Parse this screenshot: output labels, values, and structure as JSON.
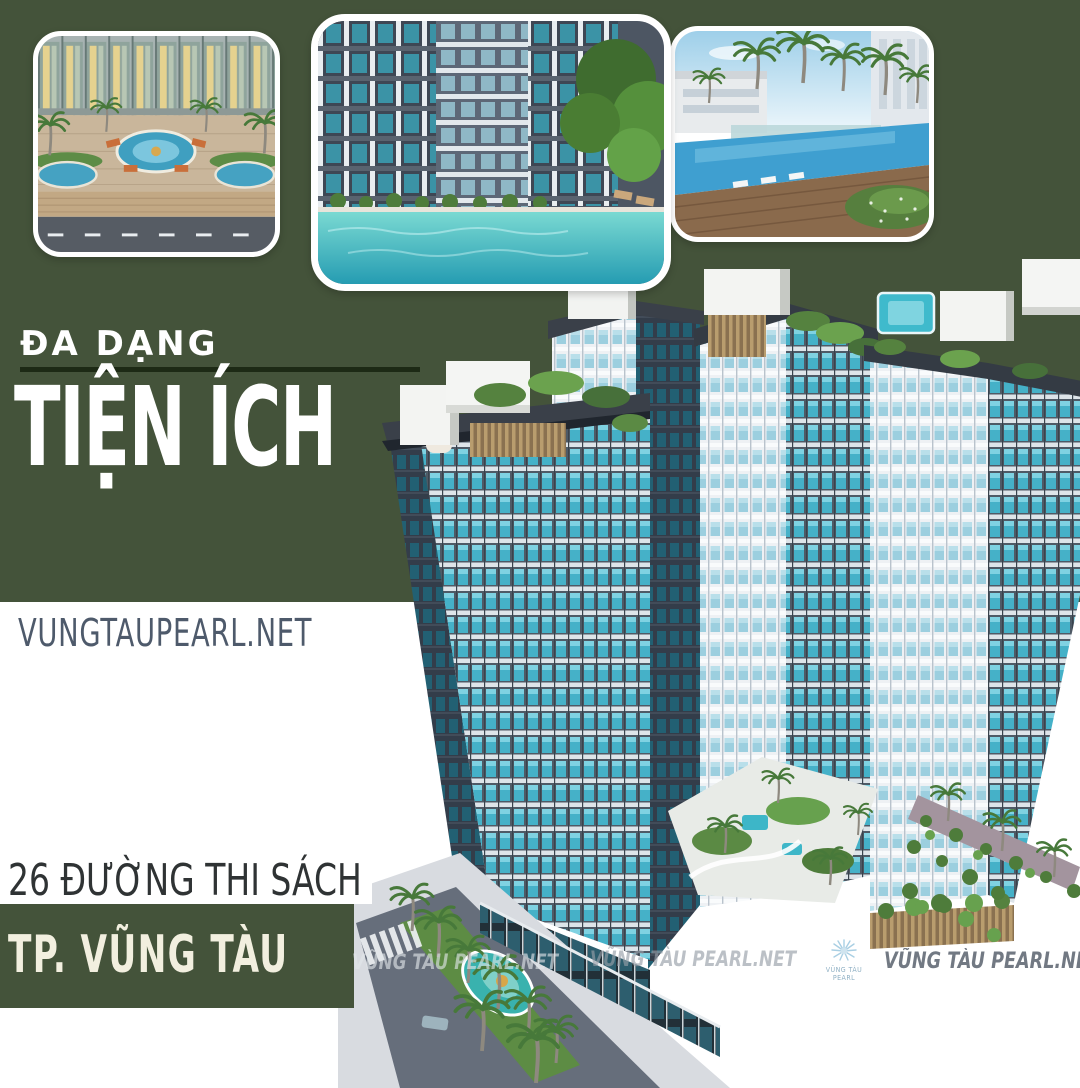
{
  "poster": {
    "kicker": "ĐA DẠNG",
    "title": "TIỆN ÍCH",
    "website": "VUNGTAUPEARL.NET",
    "address_line": "26 ĐƯỜNG THI SÁCH",
    "city_line": "TP. VŨNG TÀU"
  },
  "watermarks": {
    "items": [
      "VŨNG TÀU PEARL.NET",
      "VŨNG TÀU PEARL.NET",
      "VŨNG TÀU PEARL.NET"
    ],
    "logo_text": "VŨNG TÀU PEARL"
  },
  "photos": [
    {
      "name": "courtyard-fountain-aerial"
    },
    {
      "name": "pool-courtyard-between-towers"
    },
    {
      "name": "resort-pool-palms"
    }
  ],
  "colors": {
    "green": "#44533a",
    "divider": "#1d2a15",
    "cream": "#f2efdf",
    "ink": "#2f3334",
    "website_text": "#4e5a6b",
    "watermark": "#969ea8",
    "watermark_dark": "#727983",
    "facade_teal": "#45b1c8",
    "pool_teal": "#3fbacc",
    "roof_green": "#5b8a44"
  }
}
